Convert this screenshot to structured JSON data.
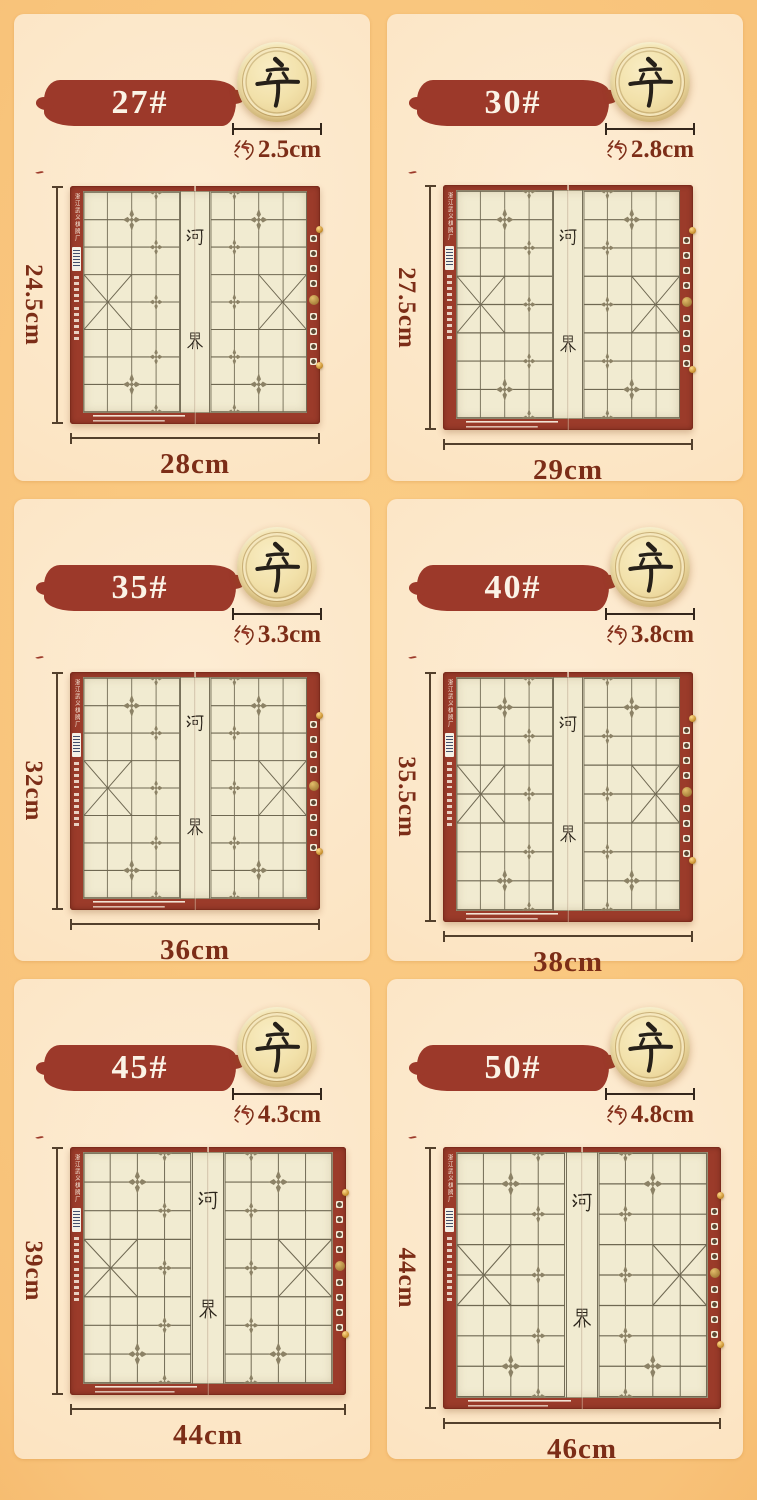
{
  "page": {
    "description_colors": {
      "background_orange": "#f3ab55",
      "panel_background": "#fce5c4",
      "badge_red": "#9c392a",
      "dimension_text": "#7c2d17",
      "board_border_red": "#9b3b2a",
      "board_field": "#f1ebd1",
      "piece_wood": "#f2e1aa"
    }
  },
  "board_common": {
    "river_top_char": "河",
    "river_bottom_char": "界",
    "piece_character": "辛",
    "approx_prefix": "约",
    "side_text": "浙江武义棋牌厂"
  },
  "panels": [
    {
      "size_label": "27#",
      "piece_character": "辛",
      "diameter_label": "约2.5cm",
      "diameter_value": "2.5cm",
      "board_height": "24.5cm",
      "board_width": "28cm"
    },
    {
      "size_label": "30#",
      "piece_character": "辛",
      "diameter_label": "约2.8cm",
      "diameter_value": "2.8cm",
      "board_height": "27.5cm",
      "board_width": "29cm"
    },
    {
      "size_label": "35#",
      "piece_character": "辛",
      "diameter_label": "约3.3cm",
      "diameter_value": "3.3cm",
      "board_height": "32cm",
      "board_width": "36cm"
    },
    {
      "size_label": "40#",
      "piece_character": "辛",
      "diameter_label": "约3.8cm",
      "diameter_value": "3.8cm",
      "board_height": "35.5cm",
      "board_width": "38cm"
    },
    {
      "size_label": "45#",
      "piece_character": "辛",
      "diameter_label": "约4.3cm",
      "diameter_value": "4.3cm",
      "board_height": "39cm",
      "board_width": "44cm"
    },
    {
      "size_label": "50#",
      "piece_character": "辛",
      "diameter_label": "约4.8cm",
      "diameter_value": "4.8cm",
      "board_height": "44cm",
      "board_width": "46cm"
    }
  ]
}
